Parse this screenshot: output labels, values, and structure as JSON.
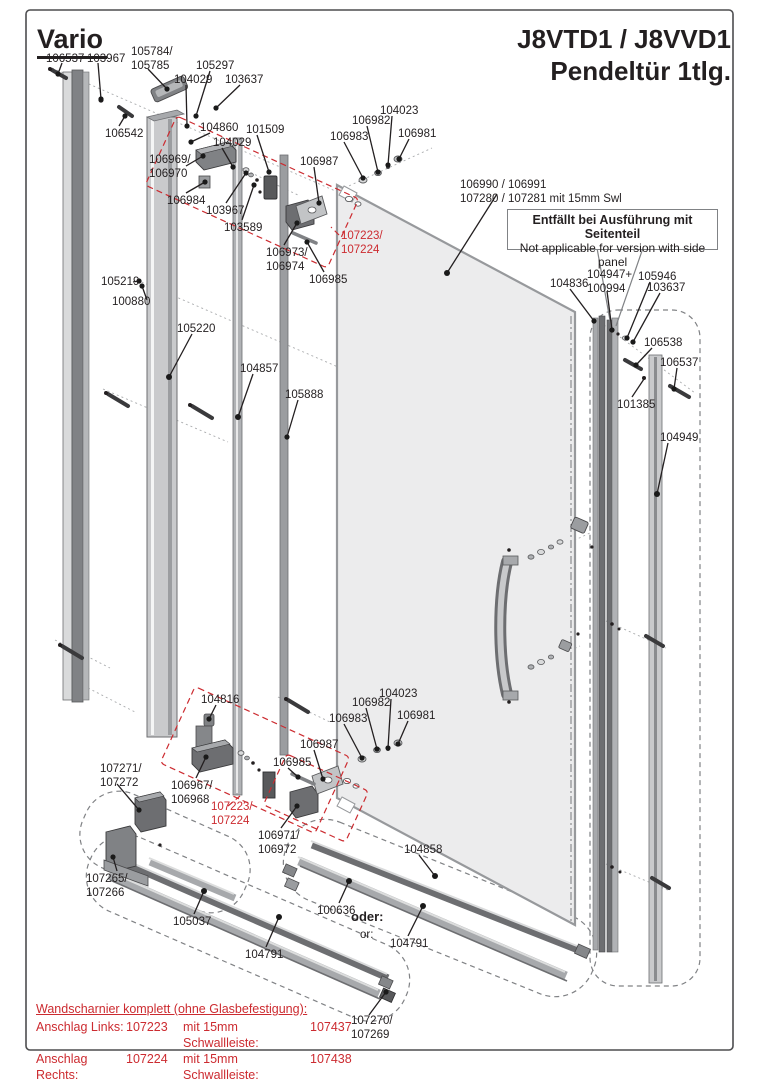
{
  "page": {
    "brand": "Vario",
    "title_line1": "J8VTD1 / J8VVD1",
    "title_line2": "Pendeltür 1tlg."
  },
  "note_box": {
    "de": "Entfällt bei Ausführung mit Seitenteil",
    "en": "Not applicable for version with side panel"
  },
  "colors": {
    "ink": "#231f20",
    "callout_red": "#cc2b30",
    "glass_fill": "#ececed",
    "profile_light": "#c9cacc",
    "profile_mid": "#a7a9ac",
    "profile_dark": "#6d6e71",
    "dashed_outline_gray": "#808285"
  },
  "labels": [
    {
      "text": "106537"
    },
    {
      "text": "103967"
    },
    {
      "text": "105784/\n105785"
    },
    {
      "text": "105297"
    },
    {
      "text": "104029"
    },
    {
      "text": "103637"
    },
    {
      "text": "106542"
    },
    {
      "text": "104860"
    },
    {
      "text": "104029"
    },
    {
      "text": "101509"
    },
    {
      "text": "106969/\n106970"
    },
    {
      "text": "106984"
    },
    {
      "text": "103967"
    },
    {
      "text": "103589"
    },
    {
      "text": "106987"
    },
    {
      "text": "106983"
    },
    {
      "text": "106982"
    },
    {
      "text": "104023"
    },
    {
      "text": "106981"
    },
    {
      "text": "106973/\n106974"
    },
    {
      "text": "107223/\n107224"
    },
    {
      "text": "106985"
    },
    {
      "text": "106990 / 106991\n107280 / 107281 mit 15mm Swl"
    },
    {
      "text": "104836"
    },
    {
      "text": "104947+\n100994"
    },
    {
      "text": "105946"
    },
    {
      "text": "103637"
    },
    {
      "text": "106538"
    },
    {
      "text": "106537"
    },
    {
      "text": "101385"
    },
    {
      "text": "104949"
    },
    {
      "text": "105219"
    },
    {
      "text": "100880"
    },
    {
      "text": "105220"
    },
    {
      "text": "104857"
    },
    {
      "text": "105888"
    },
    {
      "text": "104816"
    },
    {
      "text": "106983"
    },
    {
      "text": "106982"
    },
    {
      "text": "104023"
    },
    {
      "text": "106981"
    },
    {
      "text": "106987"
    },
    {
      "text": "106985"
    },
    {
      "text": "107271/\n107272"
    },
    {
      "text": "106967/\n106968"
    },
    {
      "text": "107223/\n107224"
    },
    {
      "text": "106971/\n106972"
    },
    {
      "text": "104858"
    },
    {
      "text": "100636"
    },
    {
      "text": "oder:"
    },
    {
      "text": "or:"
    },
    {
      "text": "104791"
    },
    {
      "text": "107265/\n107266"
    },
    {
      "text": "105037"
    },
    {
      "text": "104791"
    },
    {
      "text": "107270/\n107269"
    }
  ],
  "hinge_table": {
    "header": "Wandscharnier komplett (ohne Glasbefestigung):",
    "rows": [
      {
        "anschlag": "Anschlag Links:",
        "part": "107223",
        "swl_label": "mit 15mm Schwallleiste:",
        "swl_part": "107437"
      },
      {
        "anschlag": "Anschlag Rechts:",
        "part": "107224",
        "swl_label": "mit 15mm Schwallleiste:",
        "swl_part": "107438"
      }
    ]
  }
}
